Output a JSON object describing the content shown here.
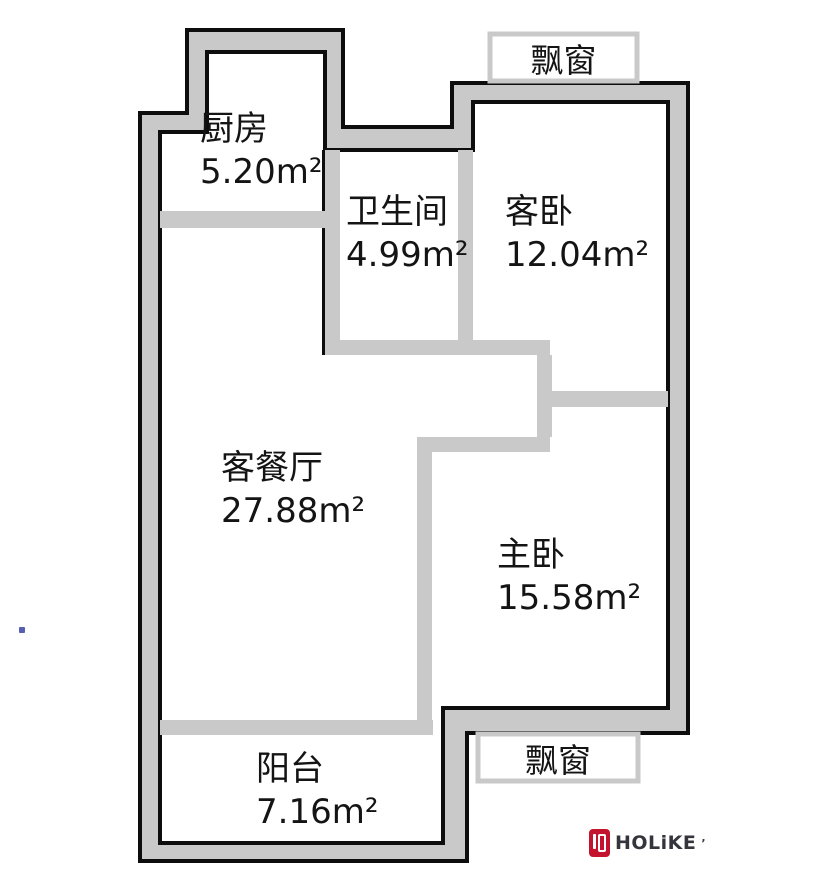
{
  "bay_windows": {
    "top": "飘窗",
    "bottom": "飘窗"
  },
  "rooms": [
    {
      "id": "kitchen",
      "name": "厨房",
      "area": "5.20m²"
    },
    {
      "id": "bathroom",
      "name": "卫生间",
      "area": "4.99m²"
    },
    {
      "id": "guest_bedroom",
      "name": "客卧",
      "area": "12.04m²"
    },
    {
      "id": "living_dining",
      "name": "客餐厅",
      "area": "27.88m²"
    },
    {
      "id": "master_bedroom",
      "name": "主卧",
      "area": "15.58m²"
    },
    {
      "id": "balcony",
      "name": "阳台",
      "area": "7.16m²"
    }
  ],
  "logo": {
    "brand": "HOLiKE",
    "mark": "’"
  },
  "colors": {
    "wall_fill": "#c9c9c9",
    "outline": "#0d0d0d",
    "text": "#141414",
    "brand_red": "#c3132e",
    "brand_text": "#35353d",
    "artifact_blue": "#5560b0"
  }
}
